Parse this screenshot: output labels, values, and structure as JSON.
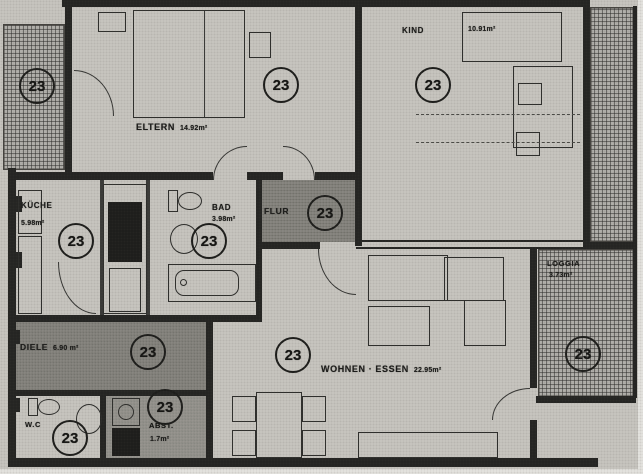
{
  "document": {
    "kind": "apartment-floor-plan",
    "language": "de"
  },
  "unit": {
    "number": "23"
  },
  "rooms": {
    "eltern": {
      "label": "ELTERN",
      "area": "14.92m²"
    },
    "kind": {
      "label": "KIND",
      "area": "10.91m²"
    },
    "kueche": {
      "label": "KÜCHE",
      "area": "5.98m²"
    },
    "bad": {
      "label": "BAD",
      "area": "3.98m²"
    },
    "flur": {
      "label": "FLUR",
      "area": ""
    },
    "diele": {
      "label": "DIELE",
      "area": "6.90 m²"
    },
    "wohnen_essen": {
      "label": "WOHNEN · ESSEN",
      "area": "22.95m²"
    },
    "loggia": {
      "label": "LOGGIA",
      "area": "3.73m²"
    },
    "wc": {
      "label": "W.C",
      "area": ""
    },
    "abst": {
      "label": "ABST.",
      "area": "1.7m²"
    }
  },
  "style": {
    "paper": "#c9c7c1",
    "ink": "#242422",
    "shaded_zone": "#8f8d87"
  }
}
